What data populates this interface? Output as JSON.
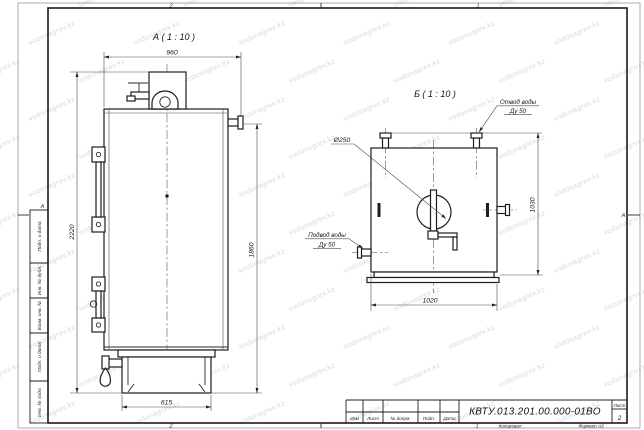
{
  "watermark": {
    "text": "vodonagrev.kz"
  },
  "sheet": {
    "zone_top_left": "2",
    "zone_top_right": "1",
    "zone_bottom_left": "2",
    "zone_bottom_right": "1",
    "zone_row_left": "А",
    "zone_row_right": "А",
    "filing_labels": [
      "Подп. и дата",
      "Инв. № дубл.",
      "Взам. инв. №",
      "Подп. и дата",
      "Инв. № подл."
    ]
  },
  "title_block": {
    "doc_number": "КВТУ.013.201.00.000-01ВО",
    "col_izm": "Изм",
    "col_list": "Лист",
    "col_doc": "№ докум.",
    "col_podp": "Подп.",
    "col_data": "Дата",
    "sheet_label": "Лист",
    "sheet_number": "2",
    "copied_label": "Копировал",
    "format_label": "Формат А3"
  },
  "view_a": {
    "label": "А ( 1 : 10 )",
    "dim_width_top": "960",
    "dim_height_total": "2220",
    "dim_height_body": "1860",
    "dim_base_width": "615"
  },
  "view_b": {
    "label": "Б ( 1 : 10 )",
    "dim_width": "1020",
    "dim_height": "1030",
    "dim_flue_diameter": "Ø250",
    "outlet_callout_line1": "Отвод воды",
    "outlet_callout_line2": "Ду 50",
    "inlet_callout_line1": "Подвод воды",
    "inlet_callout_line2": "Ду 50"
  }
}
